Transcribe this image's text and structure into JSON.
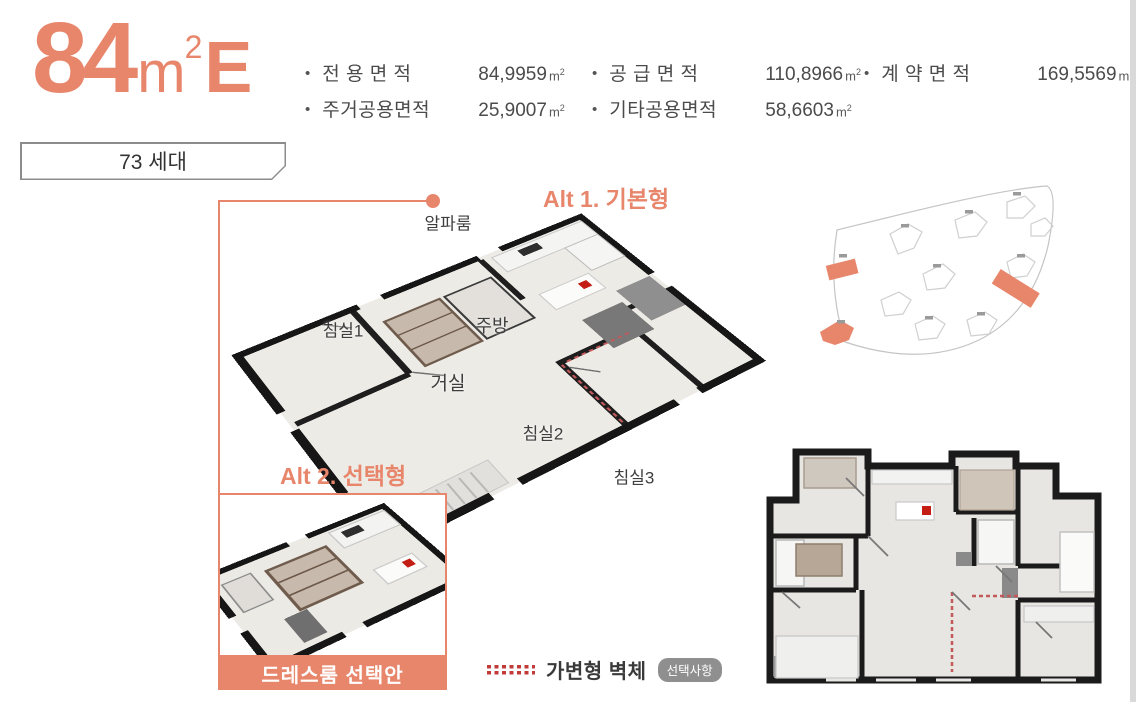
{
  "colors": {
    "accent": "#E8866C",
    "text_dark": "#3E3E3E",
    "text_gray": "#4B4B4B",
    "wall_black": "#1B1B1B",
    "floor": "#EDEBE6",
    "movable_wall_red": "#C2595B",
    "stove_red": "#C41E14",
    "badge_gray": "#8F8F8F",
    "site_outline_gray": "#C9C9C9",
    "page_edge_gray": "#D9D9D9"
  },
  "header": {
    "size": "84",
    "unit_base": "m",
    "unit_exp": "2",
    "type_letter": "E",
    "households": "73 세대"
  },
  "specs": {
    "rows": [
      [
        {
          "label": "전 용 면 적",
          "value": "84,9959",
          "unit_base": "m",
          "unit_exp": "2"
        },
        {
          "label": "공 급 면 적",
          "value": "110,8966",
          "unit_base": "m",
          "unit_exp": "2"
        },
        {
          "label": "계 약 면 적",
          "value": "169,5569",
          "unit_base": "m",
          "unit_exp": "2"
        }
      ],
      [
        {
          "label": "주거공용면적",
          "value": "25,9007",
          "unit_base": "m",
          "unit_exp": "2"
        },
        {
          "label": "기타공용면적",
          "value": "58,6603",
          "unit_base": "m",
          "unit_exp": "2"
        }
      ]
    ]
  },
  "plan3d": {
    "alt1_label": "Alt 1. 기본형",
    "rooms": [
      {
        "label": "알파룸"
      },
      {
        "label": "침실1"
      },
      {
        "label": "주방"
      },
      {
        "label": "거실"
      },
      {
        "label": "침실2"
      },
      {
        "label": "침실3"
      }
    ]
  },
  "alt2": {
    "label": "Alt 2. 선택형",
    "banner": "드레스룸 선택안"
  },
  "legend": {
    "wall_label": "가변형 벽체",
    "badge": "선택사항"
  }
}
